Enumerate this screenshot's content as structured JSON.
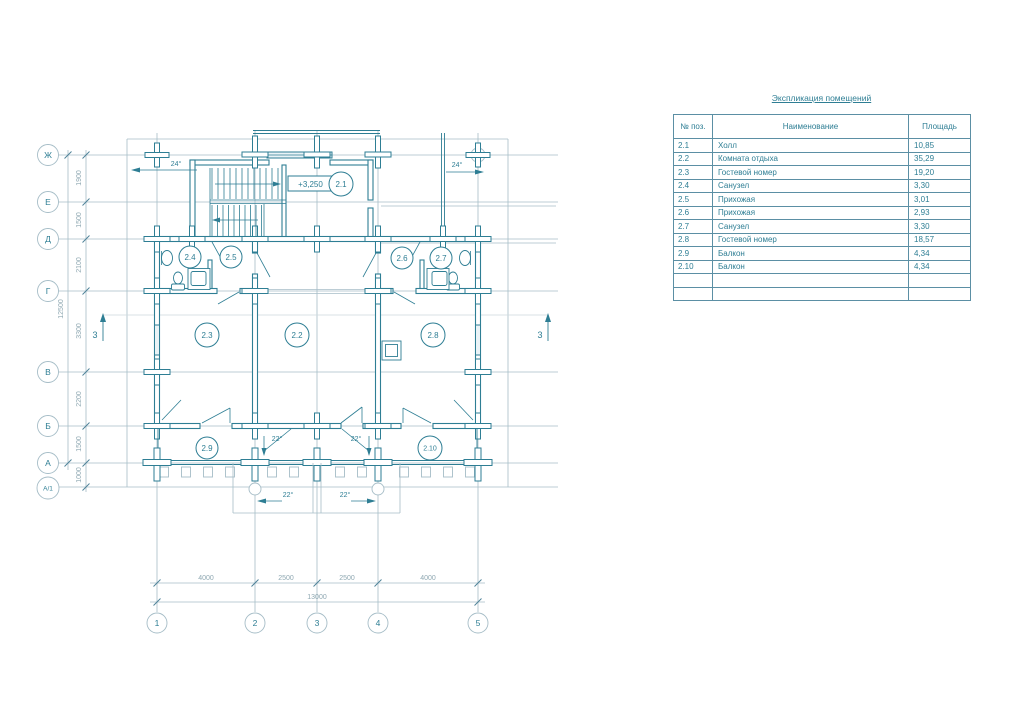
{
  "plan": {
    "axis_rows": [
      "Ж",
      "Е",
      "Д",
      "Г",
      "В",
      "Б",
      "А",
      "А/1"
    ],
    "axis_cols": [
      "1",
      "2",
      "3",
      "4",
      "5"
    ],
    "dims_left": [
      "1900",
      "1500",
      "2100",
      "3300",
      "2200",
      "1500",
      "1000"
    ],
    "dims_left_total": "12500",
    "dims_bottom": [
      "4000",
      "2500",
      "2500",
      "4000"
    ],
    "dims_bottom_total": "13000",
    "rooms": [
      "2.1",
      "2.2",
      "2.3",
      "2.4",
      "2.5",
      "2.6",
      "2.7",
      "2.8",
      "2.9",
      "2.10"
    ],
    "level_mark": "+3,250",
    "slope_roof": "24°",
    "slope_balcony": "22°",
    "section_label": "3"
  },
  "table": {
    "title": "Экспликация помещений",
    "headers": [
      "№ поз.",
      "Наименование",
      "Площадь"
    ],
    "rows": [
      {
        "pos": "2.1",
        "name": "Холл",
        "area": "10,85"
      },
      {
        "pos": "2.2",
        "name": "Комната отдыха",
        "area": "35,29"
      },
      {
        "pos": "2.3",
        "name": "Гостевой номер",
        "area": "19,20"
      },
      {
        "pos": "2.4",
        "name": "Санузел",
        "area": "3,30"
      },
      {
        "pos": "2.5",
        "name": "Прихожая",
        "area": "3,01"
      },
      {
        "pos": "2.6",
        "name": "Прихожая",
        "area": "2,93"
      },
      {
        "pos": "2.7",
        "name": "Санузел",
        "area": "3,30"
      },
      {
        "pos": "2.8",
        "name": "Гостевой номер",
        "area": "18,57"
      },
      {
        "pos": "2.9",
        "name": "Балкон",
        "area": "4,34"
      },
      {
        "pos": "2.10",
        "name": "Балкон",
        "area": "4,34"
      }
    ]
  },
  "colors": {
    "ink": "#2e7e94",
    "grid": "#a6bdc7",
    "dim_text": "#8fa8b2",
    "table_border": "#5b8fa4"
  }
}
